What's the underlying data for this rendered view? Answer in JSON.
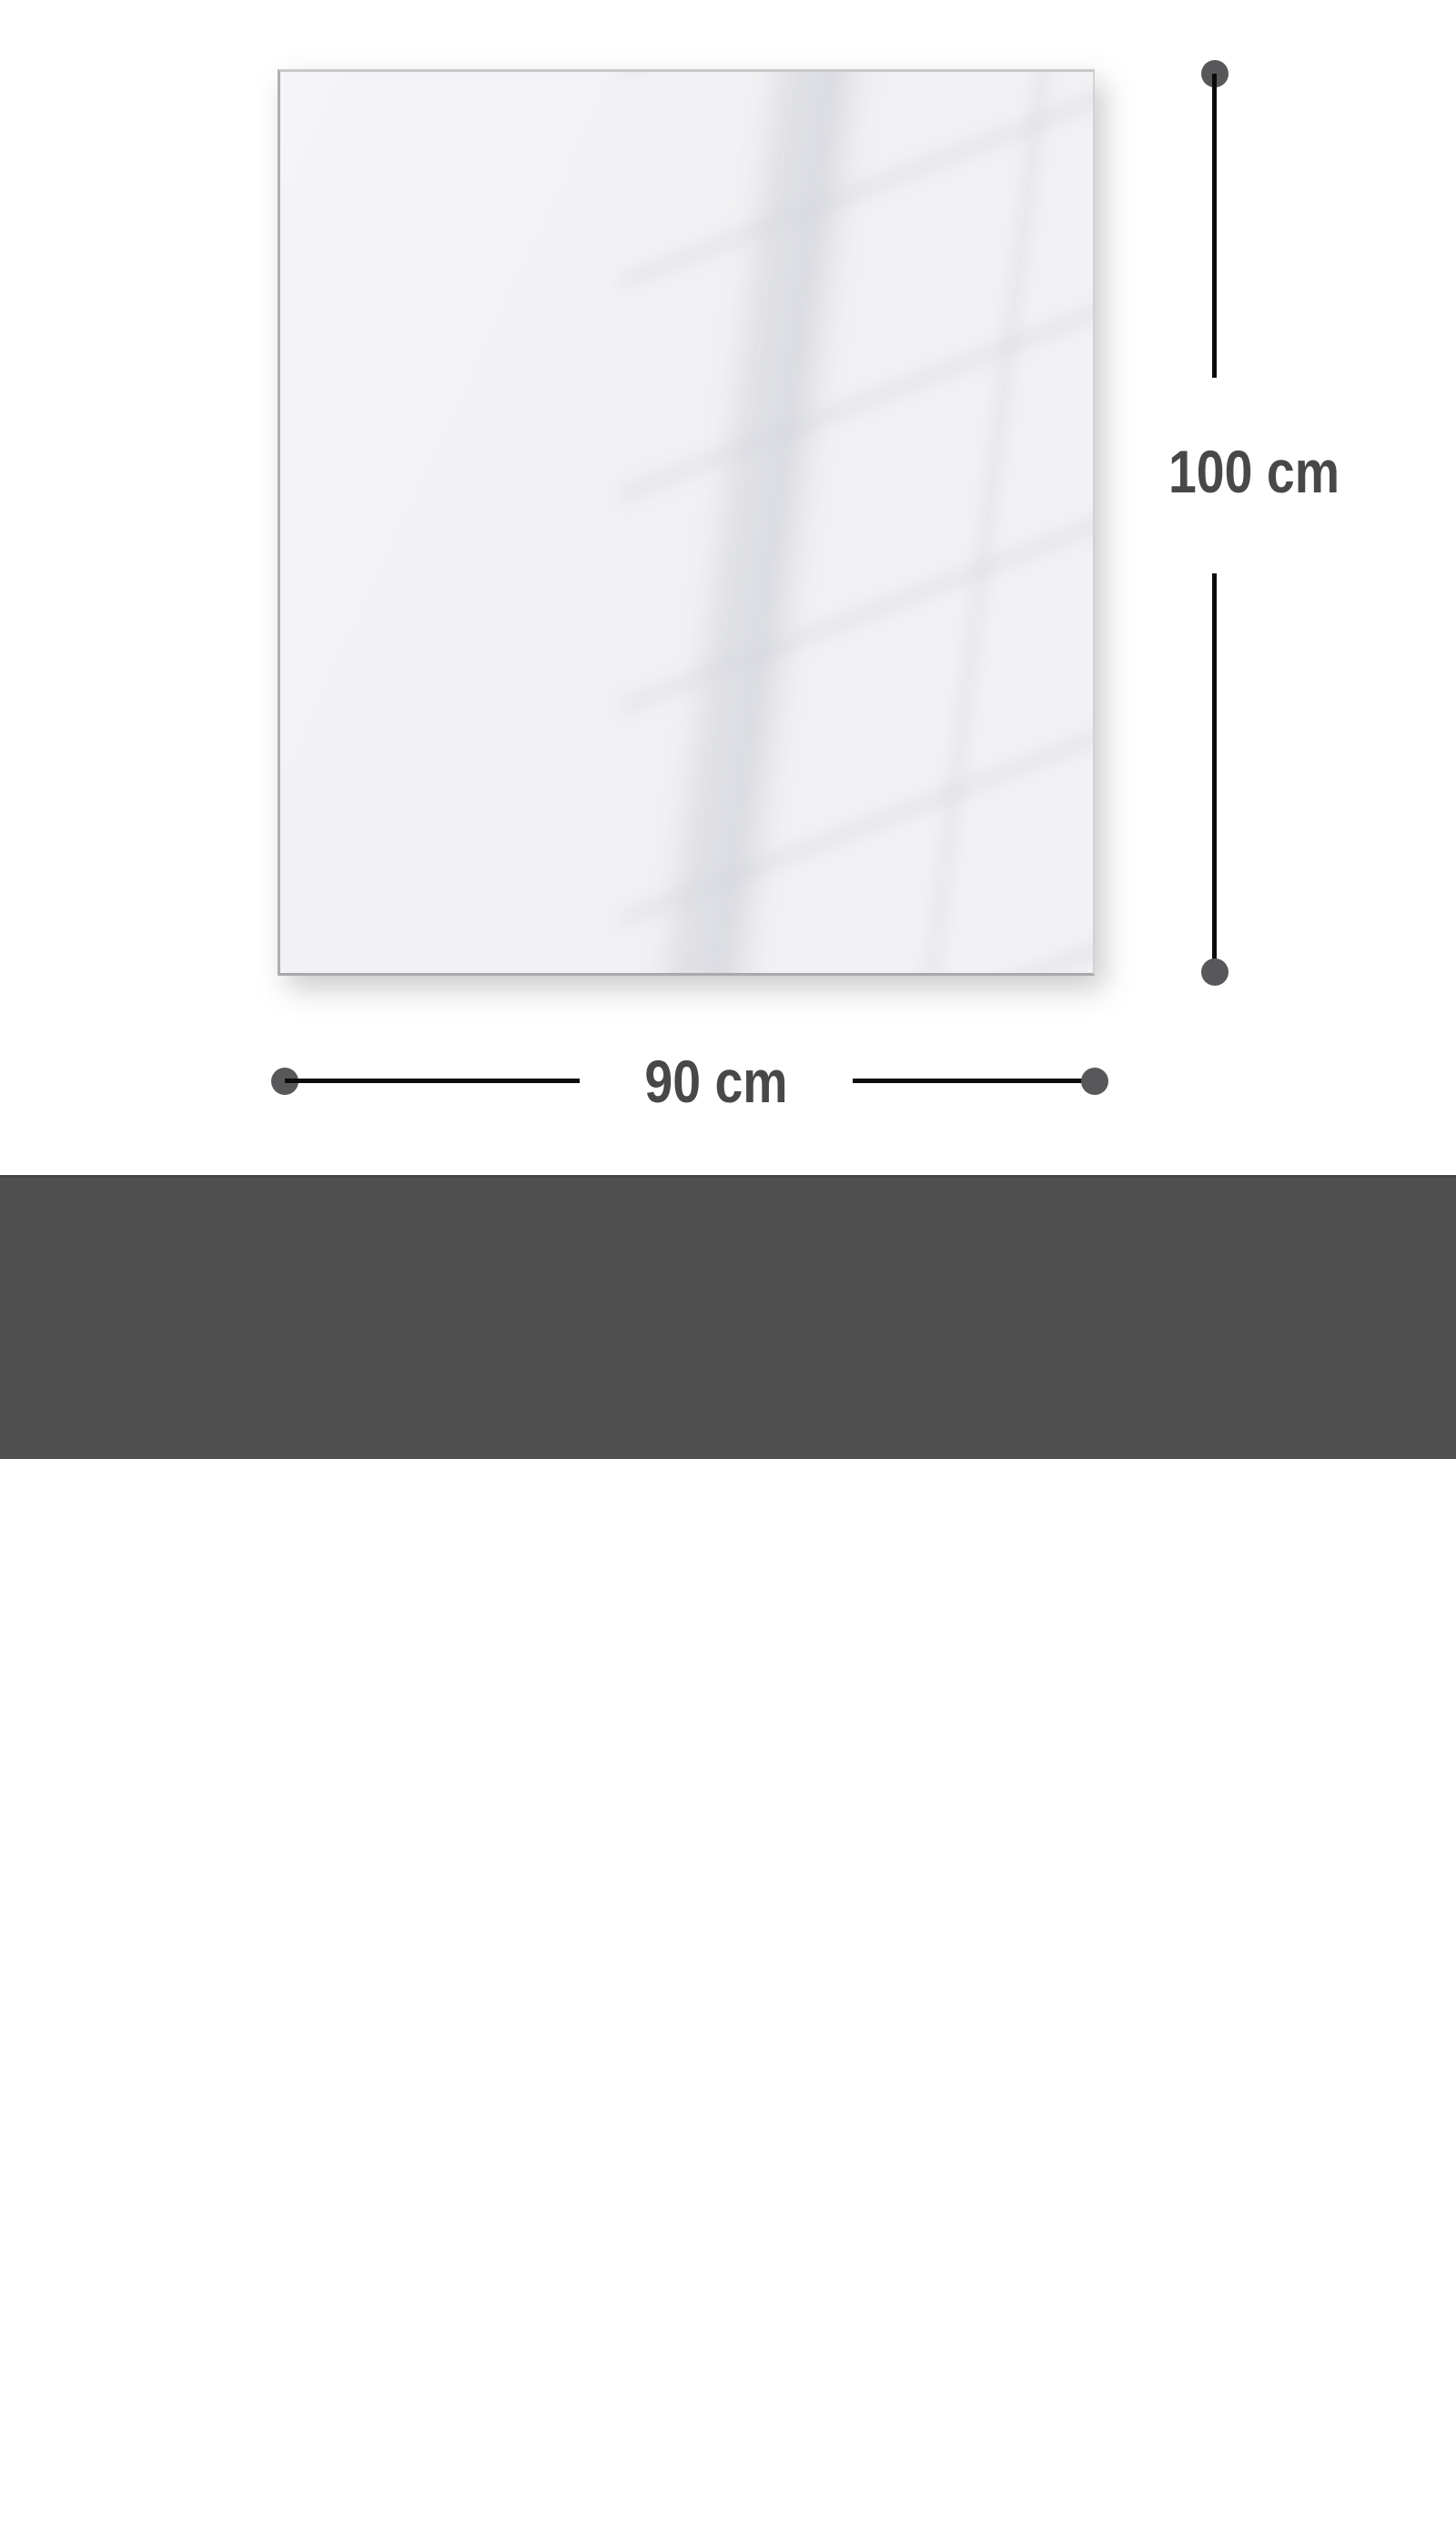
{
  "panel": {
    "description": "blank glossy glass panel preview with faint window reflection"
  },
  "dimensions": {
    "height_label": "100 cm",
    "width_label": "90 cm"
  },
  "footer": {
    "title": "Gesamtgrösse | Size",
    "size_value": "90 x 100 cm"
  },
  "colors": {
    "page_background": "#ffffff",
    "panel_fill": "#f2f2f4",
    "reflection_line": "#d6d8df",
    "dimension_line": "#0c0c0c",
    "dimension_dot": "#58585a",
    "dimension_text": "#48484a",
    "footer_background": "#4f4f50",
    "footer_text": "#ffffff"
  }
}
